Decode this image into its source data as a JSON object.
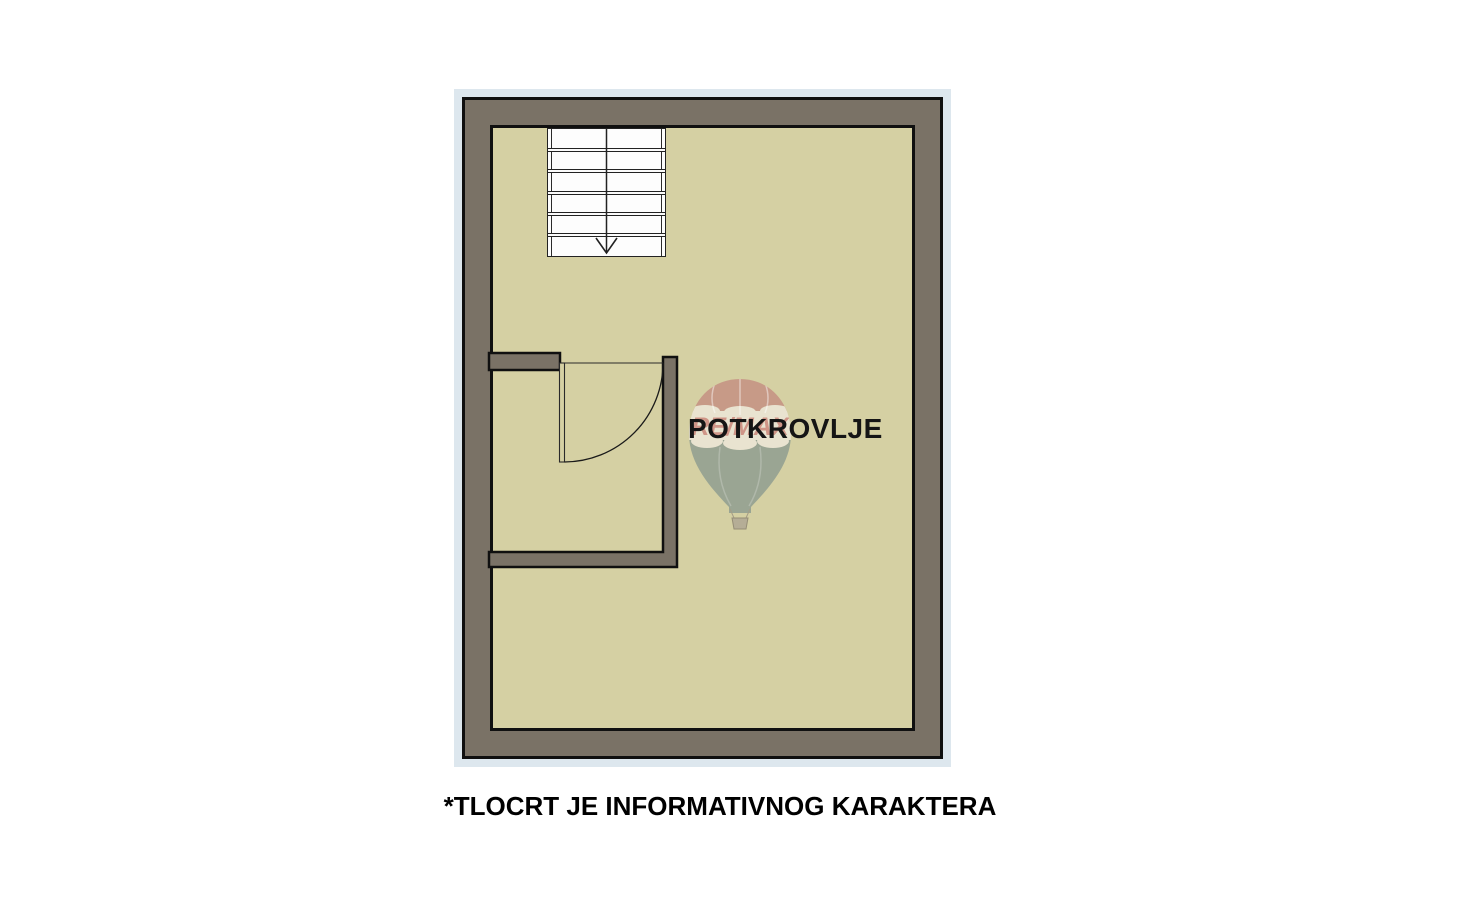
{
  "floor_plan": {
    "room_label": "POTKROVLJE",
    "stairs": {
      "tread_rows": 6,
      "direction": "down"
    },
    "colors": {
      "wall": "#7a7266",
      "floor": "#d5d0a3",
      "outline": "#101010",
      "halo": "#dde7ee"
    },
    "watermark": {
      "brand_text": "RE/MAX",
      "balloon_red": "#c79a87",
      "balloon_cream": "#e9e3d0",
      "balloon_sage": "#9aa593",
      "basket": "#b5ad96",
      "brand_red": "#b5483f"
    }
  },
  "caption": {
    "text": "*TLOCRT JE INFORMATIVNOG KARAKTERA"
  }
}
